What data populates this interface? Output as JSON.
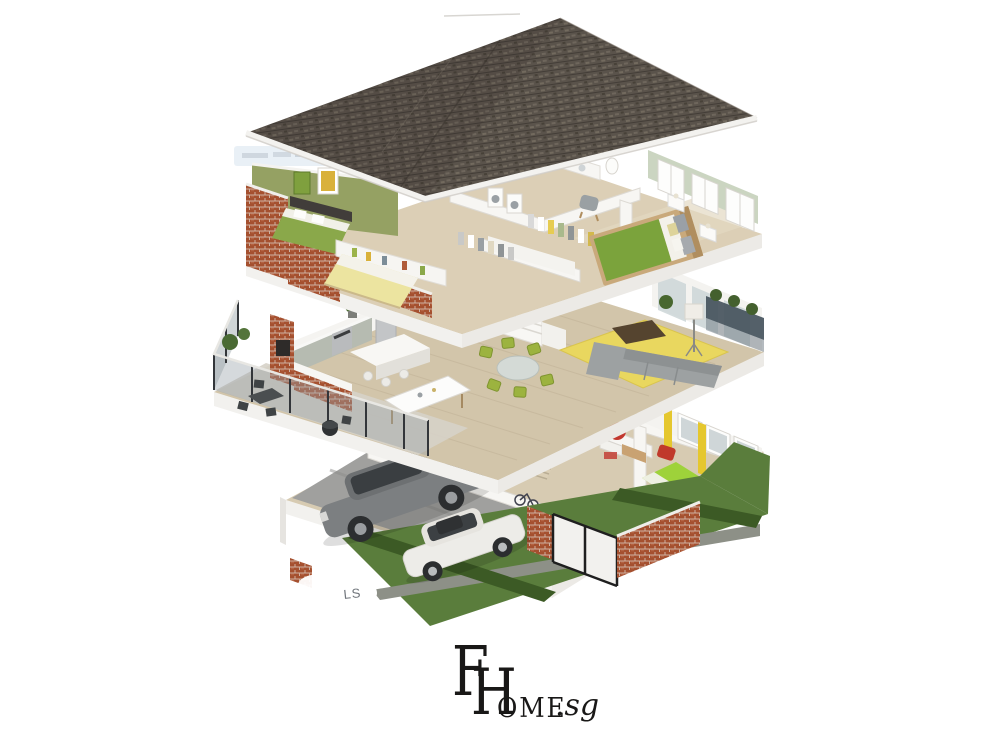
{
  "branding": {
    "monogram": [
      "F",
      "H"
    ],
    "wordmark": "OME",
    "tld": ".sg"
  },
  "watermarks": {
    "corner_fragment": "LS"
  },
  "palette": {
    "background": "#ffffff",
    "roof_shingle": "#5a534b",
    "fascia_white": "#f3f2ef",
    "brick": "#a5502f",
    "olive_feature_wall": "#95a163",
    "pale_green_wall": "#cbd5c1",
    "wood_floor": "#d7cbb2",
    "grass": "#5a7d3c",
    "hedge": "#3c5a25",
    "garden_path": "#8d9087",
    "driveway": "#a0a09e",
    "rug_yellow": "#e9d75f",
    "sofa_gray": "#9da1a2",
    "dining_chair_green": "#9cb33f",
    "bed_green": "#7ba33c",
    "bed_lime": "#9ed23a",
    "bed_yellow": "#ece4a0",
    "accent_red": "#c2372e",
    "curtain_yellow": "#e5c72e",
    "suv_gray": "#7c7f81",
    "car_white": "#edece8",
    "logo_ink": "#191817"
  }
}
